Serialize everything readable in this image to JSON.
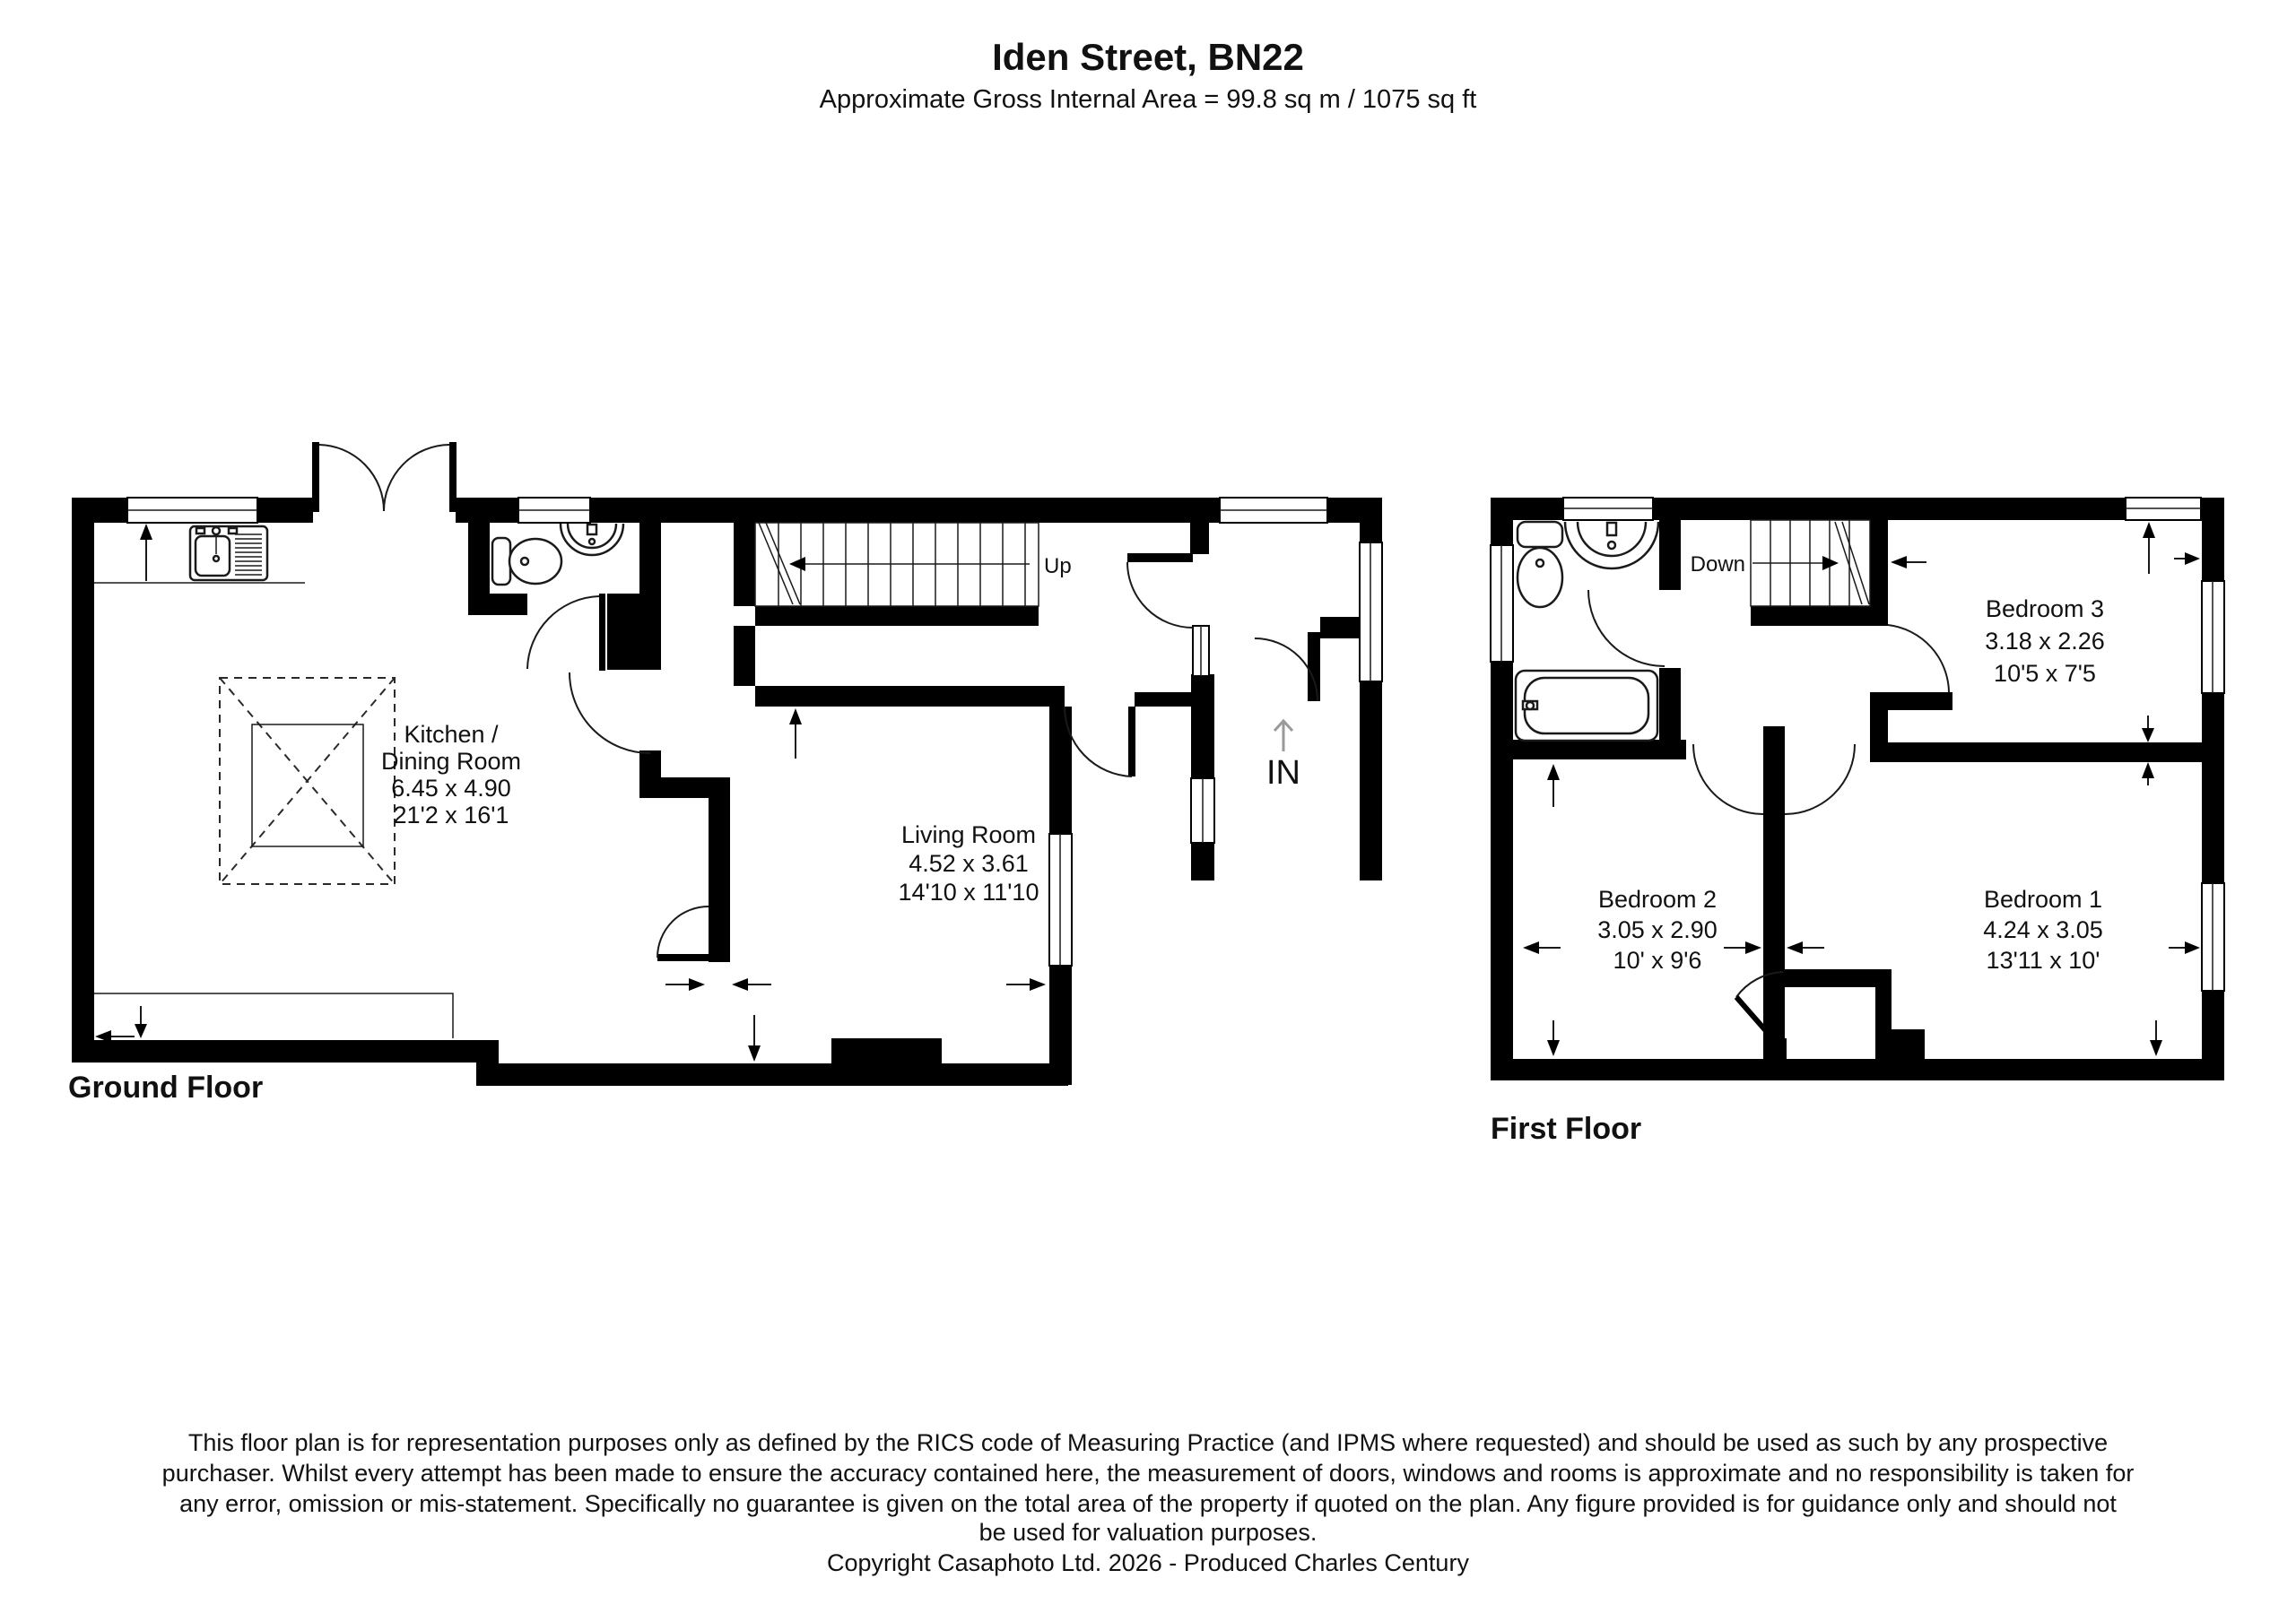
{
  "header": {
    "title": "Iden Street, BN22",
    "subtitle": "Approximate Gross Internal Area = 99.8 sq m / 1075 sq ft"
  },
  "colors": {
    "wall": "#000000",
    "background": "#ffffff",
    "entry_arrow": "#9a9a9a"
  },
  "ground_floor": {
    "label": "Ground Floor",
    "stair_direction": "Up",
    "entrance_label": "IN",
    "rooms": {
      "kitchen": {
        "name_line1": "Kitchen /",
        "name_line2": "Dining Room",
        "metric": "6.45 x 4.90",
        "imperial": "21'2 x 16'1"
      },
      "living": {
        "name": "Living Room",
        "metric": "4.52 x 3.61",
        "imperial": "14'10 x 11'10"
      }
    }
  },
  "first_floor": {
    "label": "First Floor",
    "stair_direction": "Down",
    "rooms": {
      "bedroom3": {
        "name": "Bedroom 3",
        "metric": "3.18 x 2.26",
        "imperial": "10'5 x 7'5"
      },
      "bedroom2": {
        "name": "Bedroom 2",
        "metric": "3.05 x 2.90",
        "imperial": "10' x 9'6"
      },
      "bedroom1": {
        "name": "Bedroom 1",
        "metric": "4.24 x 3.05",
        "imperial": "13'11 x 10'"
      }
    }
  },
  "footer": {
    "disclaimer_lines": [
      "This floor plan is for representation purposes only as defined by the RICS code of Measuring Practice (and IPMS where requested) and should be used as such by any prospective",
      "purchaser. Whilst every attempt has been made to ensure the accuracy contained here, the measurement of doors, windows and rooms is approximate and no responsibility is taken for",
      "any error, omission or mis-statement. Specifically no guarantee is given on the total area of the property if quoted on the plan. Any figure provided is for guidance only and should not",
      "be used for valuation purposes."
    ],
    "copyright": "Copyright Casaphoto Ltd. 2026 - Produced Charles Century"
  }
}
